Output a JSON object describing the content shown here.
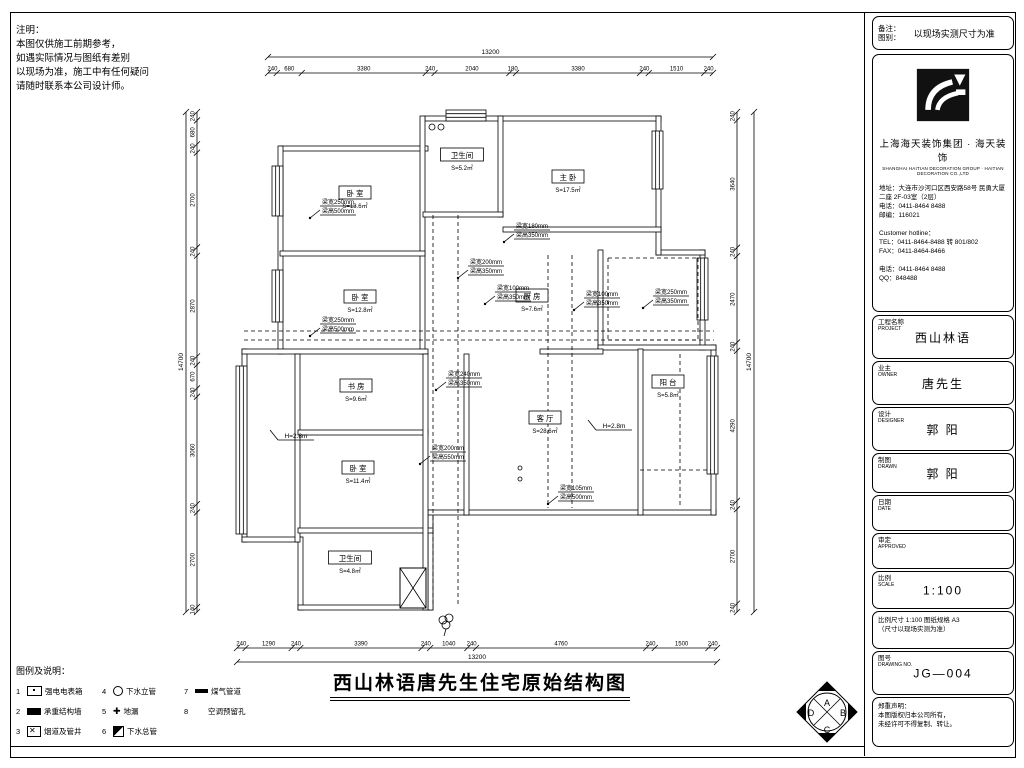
{
  "note": {
    "lines": [
      "注明：",
      "本图仅供施工前期参考，",
      "如遇实际情况与图纸有差别",
      "以现场为准，施工中有任何疑问",
      "请随时联系本公司设计师。"
    ]
  },
  "drawing": {
    "title": "西山林语唐先生住宅原始结构图",
    "dims": {
      "top": {
        "total": "13200",
        "vals": [
          "240",
          "680",
          "3380",
          "240",
          "2040",
          "180",
          "3380",
          "240",
          "1510",
          "240"
        ]
      },
      "bottom": {
        "total": "13200",
        "vals": [
          "240",
          "1290",
          "240",
          "3390",
          "240",
          "1040",
          "240",
          "4760",
          "240",
          "1500",
          "240"
        ]
      },
      "left": {
        "total": "14700",
        "vals": [
          "240",
          "680",
          "240",
          "2700",
          "240",
          "2870",
          "240",
          "670",
          "240",
          "3060",
          "240",
          "2700",
          "140"
        ]
      },
      "right": {
        "total": "14700",
        "vals": [
          "240",
          "3640",
          "240",
          "2470",
          "240",
          "4290",
          "240",
          "2700",
          "240"
        ]
      }
    },
    "rooms": [
      {
        "x": 355,
        "y": 193,
        "name": "卧 室",
        "area": "S=13.6㎡"
      },
      {
        "x": 462,
        "y": 155,
        "name": "卫生间",
        "area": "S=5.2㎡"
      },
      {
        "x": 568,
        "y": 177,
        "name": "主 卧",
        "area": "S=17.5㎡"
      },
      {
        "x": 360,
        "y": 297,
        "name": "卧 室",
        "area": "S=12.8㎡"
      },
      {
        "x": 532,
        "y": 296,
        "name": "厨 房",
        "area": "S=7.6㎡"
      },
      {
        "x": 545,
        "y": 418,
        "name": "客 厅",
        "area": "S=28.6㎡"
      },
      {
        "x": 668,
        "y": 382,
        "name": "阳 台",
        "area": "S=5.8㎡"
      },
      {
        "x": 356,
        "y": 386,
        "name": "书 房",
        "area": "S=9.6㎡"
      },
      {
        "x": 358,
        "y": 468,
        "name": "卧 室",
        "area": "S=11.4㎡"
      },
      {
        "x": 350,
        "y": 558,
        "name": "卫生间",
        "area": "S=4.8㎡"
      }
    ],
    "beams": [
      {
        "x": 322,
        "y": 204,
        "l1": "梁宽250mm",
        "l2": "梁高500mm"
      },
      {
        "x": 322,
        "y": 322,
        "l1": "梁宽250mm",
        "l2": "梁高500mm"
      },
      {
        "x": 516,
        "y": 228,
        "l1": "梁宽180mm",
        "l2": "梁高350mm"
      },
      {
        "x": 470,
        "y": 264,
        "l1": "梁宽200mm",
        "l2": "梁高350mm"
      },
      {
        "x": 497,
        "y": 290,
        "l1": "梁宽100mm",
        "l2": "梁高350mm"
      },
      {
        "x": 586,
        "y": 296,
        "l1": "梁宽100mm",
        "l2": "梁高350mm"
      },
      {
        "x": 655,
        "y": 294,
        "l1": "梁宽250mm",
        "l2": "梁高350mm"
      },
      {
        "x": 448,
        "y": 376,
        "l1": "梁宽240mm",
        "l2": "梁高350mm"
      },
      {
        "x": 432,
        "y": 450,
        "l1": "梁宽200mm",
        "l2": "梁高550mm"
      },
      {
        "x": 560,
        "y": 490,
        "l1": "梁宽105mm",
        "l2": "梁高500mm"
      }
    ],
    "height_notes": [
      {
        "x": 282,
        "y": 438,
        "text": "H=2.8m"
      },
      {
        "x": 600,
        "y": 428,
        "text": "H=2.8m"
      }
    ]
  },
  "legend": {
    "title": "图例及说明：",
    "items": [
      {
        "num": "1",
        "sym": "box-dot",
        "label": "强电电表箱"
      },
      {
        "num": "2",
        "sym": "solid",
        "label": "承重结构墙"
      },
      {
        "num": "3",
        "sym": "box-x",
        "label": "烟道及管井"
      },
      {
        "num": "4",
        "sym": "circle",
        "label": "下水立管"
      },
      {
        "num": "5",
        "sym": "cross",
        "label": "地漏",
        "glyph": "✚"
      },
      {
        "num": "6",
        "sym": "half",
        "label": "下水总管"
      },
      {
        "num": "7",
        "sym": "bar",
        "label": "煤气管道"
      },
      {
        "num": "8",
        "sym": "none",
        "label": "空调预留孔"
      }
    ]
  },
  "title_block": {
    "remark": {
      "label1": "备注：",
      "label2": "图别：",
      "value": "以现场实测尺寸为准"
    },
    "company_cn": "上海海天装饰集团 · 海天装饰",
    "company_en": "SHANGHAI HAITIAN DECORATION GROUP · HAITIAN DECORATION CO.,LTD",
    "address_lines": [
      "地址：大连市沙河口区西安路58号 民勇大厦",
      "二座 2F-03室（2层）",
      "电话：0411-8464 8488",
      "邮编：116021",
      "",
      "Customer hotline：",
      "TEL：0411-8464-8488 转 801/802",
      "FAX：0411-8464-8466",
      "",
      "电话：0411-8464 8488",
      "QQ：848488"
    ],
    "boxes": [
      {
        "type": "field",
        "label": "工程名称",
        "en": "PROJECT",
        "value": "西山林语"
      },
      {
        "type": "field",
        "label": "业主",
        "en": "OWNER",
        "value": "唐先生"
      },
      {
        "type": "field",
        "label": "设计",
        "en": "DESIGNER",
        "value": "郭 阳"
      },
      {
        "type": "field",
        "label": "制图",
        "en": "DRAWN",
        "value": "郭 阳"
      },
      {
        "type": "field",
        "label": "日期",
        "en": "DATE",
        "value": ""
      },
      {
        "type": "field",
        "label": "审定",
        "en": "APPROVED",
        "value": ""
      },
      {
        "type": "field",
        "label": "比例",
        "en": "SCALE",
        "value": "1:100"
      },
      {
        "type": "note",
        "lines": [
          "比例尺寸 1:100 图纸规格 A3",
          "（尺寸以现场实测为准）"
        ]
      },
      {
        "type": "field",
        "label": "图号",
        "en": "DRAWING NO.",
        "value": "JG—004"
      },
      {
        "type": "note",
        "lines": [
          "郑重声明：",
          "本图版权归本公司所有，",
          "未经许可不得复制、转让。"
        ]
      }
    ]
  },
  "stamp": {
    "letters": [
      "A",
      "B",
      "C",
      "D"
    ]
  }
}
